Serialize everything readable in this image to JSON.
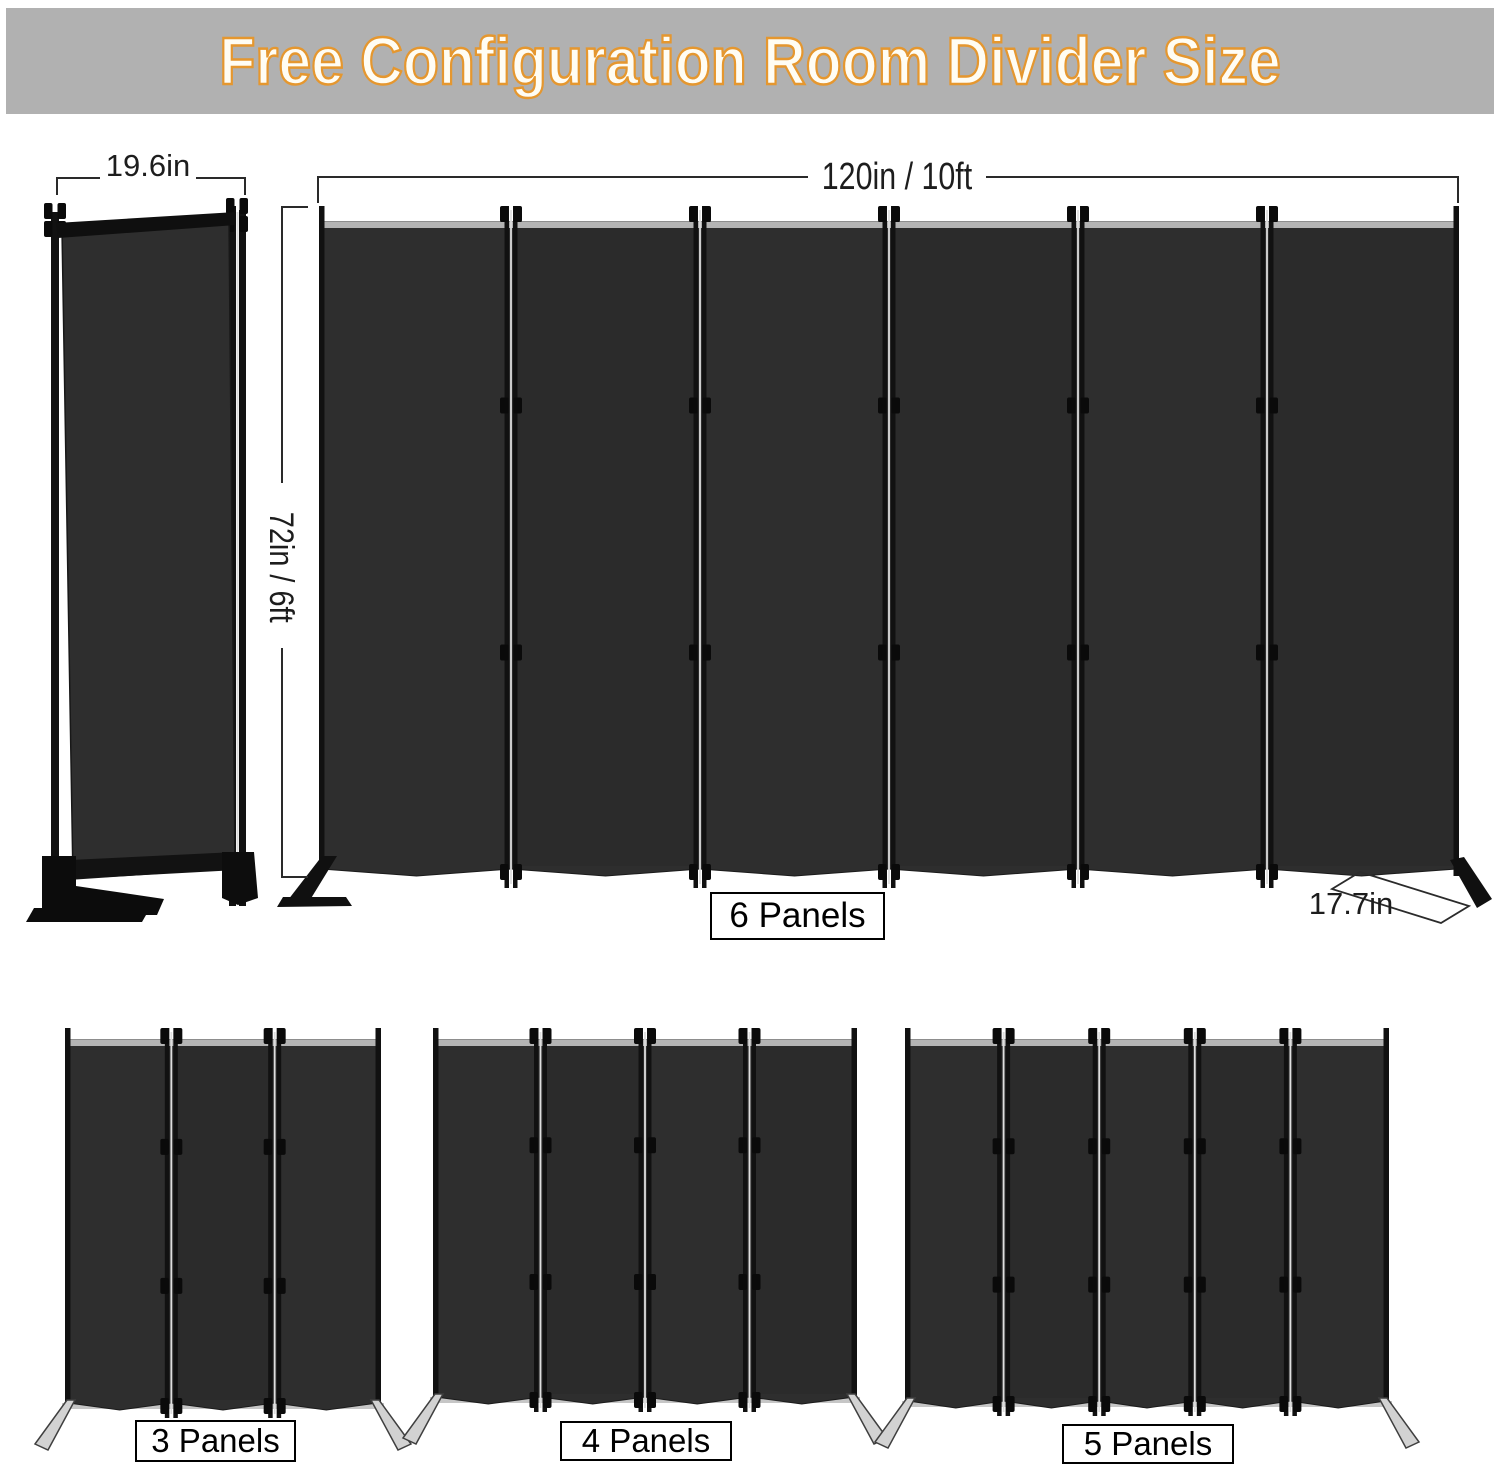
{
  "banner": {
    "title": "Free Configuration Room Divider Size"
  },
  "dimensions": {
    "folded_width": "19.6in",
    "total_width": "120in / 10ft",
    "height": "72in / 6ft",
    "foot_depth": "17.7in"
  },
  "main_divider": {
    "label": "6 Panels",
    "panels": 6
  },
  "variants": [
    {
      "label": "3 Panels",
      "panels": 3
    },
    {
      "label": "4 Panels",
      "panels": 4
    },
    {
      "label": "5 Panels",
      "panels": 5
    }
  ],
  "colors": {
    "banner_bg": "#b1b1b1",
    "title_fill": "#fffdf4",
    "title_outline": "#e5972f",
    "fabric": "#2e2e2e",
    "fabric_top_strip": "#b4b4b4",
    "frame": "#111111",
    "dimension_lines": "#2a2a2a",
    "foot_gray": "#d2d2d2"
  }
}
